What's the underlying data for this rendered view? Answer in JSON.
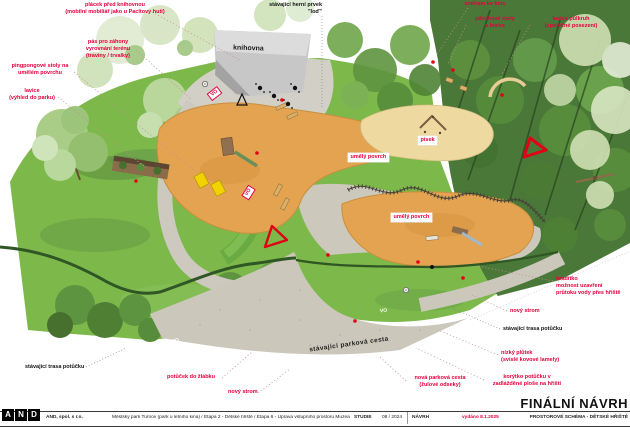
{
  "labels": {
    "placek": {
      "l1": "plácek před knihovnou",
      "l2": "(mobilní mobiliář jako u Pacltovy huti)"
    },
    "herni": {
      "l1": "stávající herní prvek",
      "l2": "\"loď\""
    },
    "smerem": {
      "l1": "směrem ke kinu"
    },
    "piknik": {
      "l1": "piknikové stoly",
      "l2": "a lavice"
    },
    "pulkruh": {
      "l1": "lavice půlkruh",
      "l2": "(společné posezení)"
    },
    "pas": {
      "l1": "pás pro záhony",
      "l2": "vyrovnání terénu",
      "l3": "(traviny / trvalky)"
    },
    "pingpong": {
      "l1": "pingpongové stoly na",
      "l2": "umělém povrchu"
    },
    "lavice_vyhled": {
      "l1": "lavice",
      "l2": "(výhled do parku)"
    },
    "hraditko": {
      "l1": "hradítko",
      "l2": "možnost uzavření",
      "l3": "průtoku vody přes hřiště"
    },
    "novy_strom_r": {
      "l1": "nový strom"
    },
    "stav_trasa_r": {
      "l1": "stávající trasa potůčku"
    },
    "plutek": {
      "l1": "nízký plůtek",
      "l2": "(svislé kovové lamely)"
    },
    "korytko": {
      "l1": "korýtko potůčku v",
      "l2": "zadlážděné ploše na hřišti"
    },
    "nova_cesta": {
      "l1": "nová parková cesta",
      "l2": "(žulové odseky)"
    },
    "stav_trasa_l": {
      "l1": "stávající trasa potůčku"
    },
    "potucek": {
      "l1": "potůček do žlábku"
    },
    "novy_strom_b": {
      "l1": "nový strom"
    },
    "stav_cesta": {
      "l1": "stávající parková cesta"
    }
  },
  "plan": {
    "building": "knihovna",
    "surface1": "umělý povrch",
    "surface2": "umělý povrch",
    "sand": "písek",
    "vo": "VO"
  },
  "titlebar": {
    "logo": {
      "a": "A",
      "n": "N",
      "d": "D"
    },
    "company": "AND, spol. s r.o.",
    "project": "Městský park Turnov (park u letního kina) / Etapa 2 - Dětské hřiště / Etapa 6 - Úprava vstupního prostoru Muzea Českého ráje",
    "stage": "STUDIE",
    "date": "08 / 2024",
    "phase": "NÁVRH",
    "issued": "vydáno 8.1.2025",
    "main_title": "FINÁLNÍ NÁVRH",
    "subtitle": "PROSTOROVÉ SCHÉMA - DĚTSKÉ HŘIŠTĚ"
  },
  "colors": {
    "accent_red": "#e3003c",
    "marker_red": "#e30016",
    "lawn_green": "#7cb84a",
    "forest_green": "#4a7838",
    "path_gray": "#cbc7bb",
    "play_orange": "#e3a350",
    "sand_yellow": "#eedaa1",
    "building_gray": "#c7c7c7",
    "pingpong_yellow": "#f2d200"
  }
}
